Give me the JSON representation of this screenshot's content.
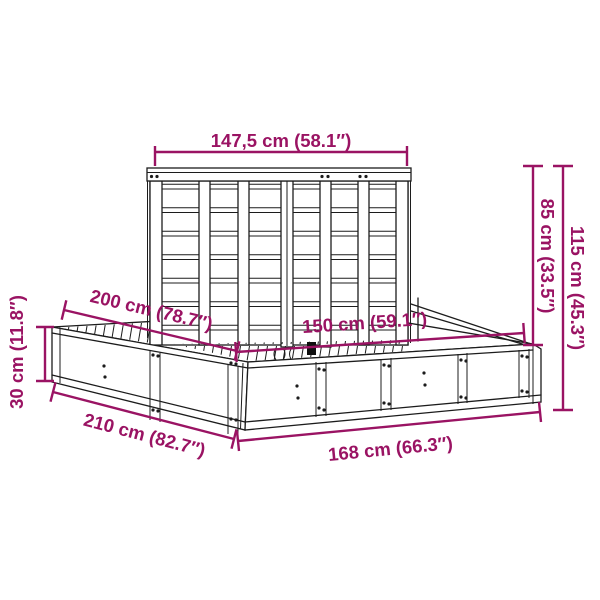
{
  "colors": {
    "accent": "#9A1363",
    "line": "#1C1C1C"
  },
  "diagram": {
    "type": "furniture-dimension-diagram",
    "unit_style": "cm (inches)"
  },
  "dimensions": {
    "headboard_width": "147,5 cm (58.1″)",
    "height_above_frame": "85 cm (33.5″)",
    "total_height": "115 cm (45.3″)",
    "inner_length": "200 cm (78.7″)",
    "frame_height": "30 cm (11.8″)",
    "inner_width": "150 cm (59.1″)",
    "outer_length": "210 cm (82.7″)",
    "outer_width": "168 cm (66.3″)"
  }
}
